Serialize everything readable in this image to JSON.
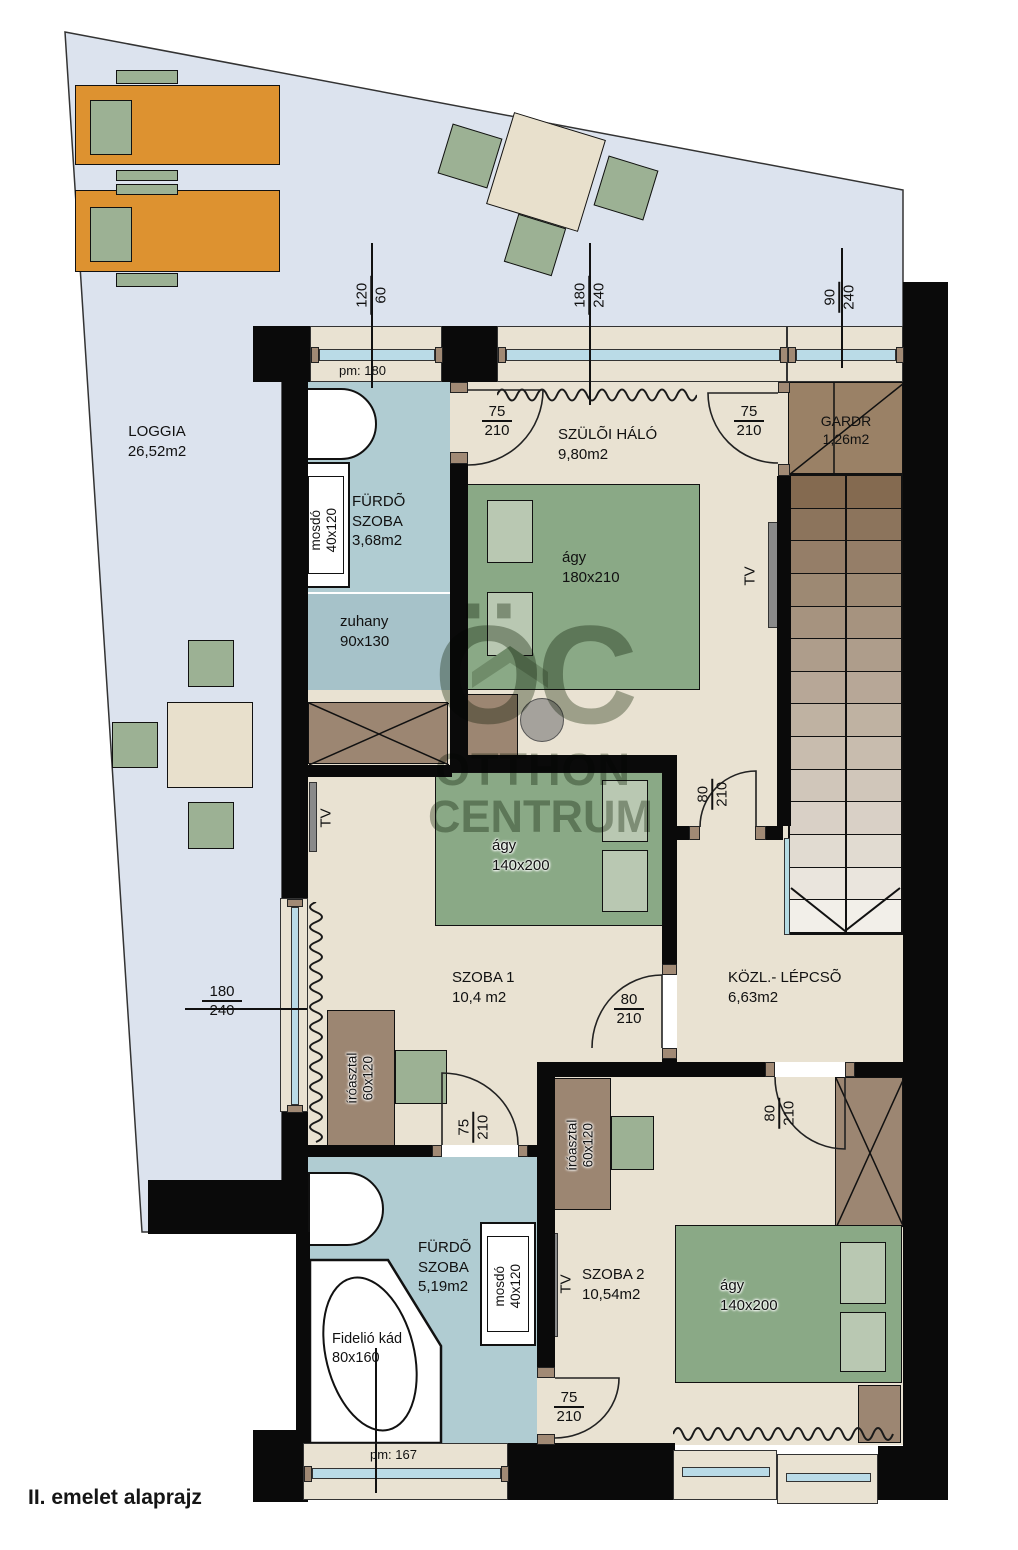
{
  "caption": "II. emelet alaprajz",
  "watermark": {
    "monogram": "ÖC",
    "line1": "OTTHON",
    "line2": "CENTRUM"
  },
  "rooms": {
    "loggia": {
      "name": "LOGGIA",
      "area": "26,52m2"
    },
    "bathroom1": {
      "line1": "FÜRDÕ",
      "line2": "SZOBA",
      "area": "3,68m2"
    },
    "master": {
      "name": "SZÜLÕI HÁLÓ",
      "area": "9,80m2"
    },
    "gardr": {
      "name": "GARDR",
      "area": "1,26m2"
    },
    "room1": {
      "name": "SZOBA 1",
      "area": "10,4 m2"
    },
    "hall": {
      "name": "KÖZL.- LÉPCSÕ",
      "area": "6,63m2"
    },
    "bathroom2": {
      "line1": "FÜRDÕ",
      "line2": "SZOBA",
      "area": "5,19m2"
    },
    "room2": {
      "name": "SZOBA 2",
      "area": "10,54m2"
    }
  },
  "furniture": {
    "master_bed": {
      "name": "ágy",
      "size": "180x210"
    },
    "room1_bed": {
      "name": "ágy",
      "size": "140x200"
    },
    "room2_bed": {
      "name": "ágy",
      "size": "140x200"
    },
    "shower": {
      "name": "zuhany",
      "size": "90x130"
    },
    "sink1": {
      "name": "mosdó",
      "size": "40x120"
    },
    "sink2": {
      "name": "mosdó",
      "size": "40x120"
    },
    "desk1": {
      "name": "íróasztal",
      "size": "60x120"
    },
    "desk2": {
      "name": "íróasztal",
      "size": "60x120"
    },
    "bathtub": {
      "name": "Fidelió kád",
      "size": "80x160"
    },
    "tv_master": "TV",
    "tv_room1": "TV",
    "tv_room2": "TV"
  },
  "dimensions": {
    "bath1_window": {
      "a": "120",
      "b": "60"
    },
    "bath1_window_pm": "pm: 180",
    "master_window": {
      "a": "180",
      "b": "240"
    },
    "gardr_window": {
      "a": "90",
      "b": "240"
    },
    "room1_window": {
      "a": "180",
      "b": "240"
    },
    "master_bath_door": {
      "a": "75",
      "b": "210"
    },
    "gardr_door": {
      "a": "75",
      "b": "210"
    },
    "master_hall_door": {
      "a": "80",
      "b": "210"
    },
    "room1_door": {
      "a": "80",
      "b": "210"
    },
    "room1_bath_door": {
      "a": "75",
      "b": "210"
    },
    "room2_door": {
      "a": "80",
      "b": "210"
    },
    "bath2_door": {
      "a": "75",
      "b": "210"
    },
    "bath2_window_pm": "pm: 167"
  },
  "colors": {
    "wall": "#0a0a0a",
    "room": "#e9e2d2",
    "bathroom": "#b0ccd2",
    "loggia": "#dce3ee",
    "bed": "#8aa986",
    "pillow": "#b9c8b2",
    "wood": "#9c8672",
    "lounger": "#dd9230",
    "glass": "#badbe7",
    "chair": "#9cb194",
    "stairs_dark": "#846a50",
    "stairs_light": "#f2efe9"
  }
}
